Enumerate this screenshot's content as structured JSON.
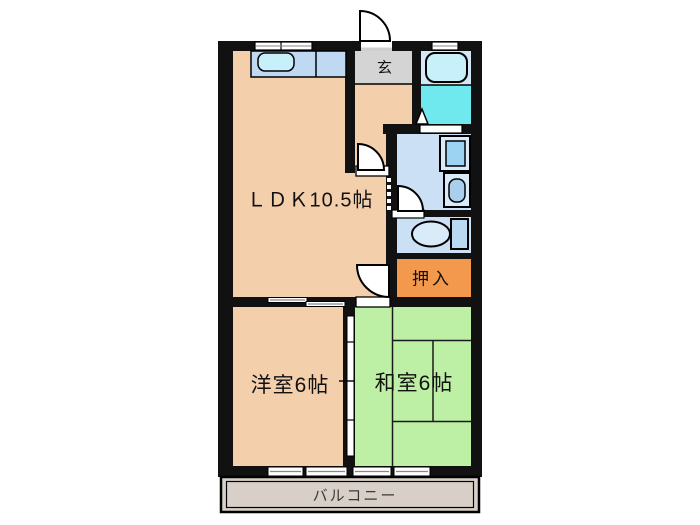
{
  "title": "2DK apartment floor plan",
  "rooms": {
    "ldk": {
      "label": "ＬＤＫ10.5帖"
    },
    "genkan": {
      "label": "玄"
    },
    "oshiire": {
      "label": "押入"
    },
    "western_room": {
      "label": "洋室6帖"
    },
    "japanese_room": {
      "label": "和室6帖"
    },
    "balcony": {
      "label": "バルコニー"
    }
  },
  "fixtures": {
    "kitchen_counter": "kitchen-counter",
    "kitchen_sink": "kitchen-sink",
    "bathtub": "bathtub",
    "bath_floor": "bath-washing-area",
    "washing_machine_pan": "washing-machine-pan",
    "washbasin": "washbasin",
    "toilet": "toilet",
    "entrance_door": "entrance-door-swing",
    "tatami": "tatami-mat-lines"
  },
  "colors": {
    "wall": "#111111",
    "floor_beige": "#F4CFAC",
    "tatami_green": "#BDEFA5",
    "genkan_gray": "#D4D4D4",
    "closet_orange": "#F2994D",
    "wet_blue": "#CCE0F5",
    "bath_light": "#D4E7F6",
    "bath_cyan": "#6FE9EE",
    "balcony_gray": "#D8D0C8",
    "counter_blue": "#BFD9F2",
    "sink_cyan": "#C7F0FA",
    "fixture_light": "#D9EBF9",
    "pan_inner": "#9CD2F2",
    "basin_inner": "#A9CFEC",
    "tank_blue": "#B9D9F2"
  }
}
